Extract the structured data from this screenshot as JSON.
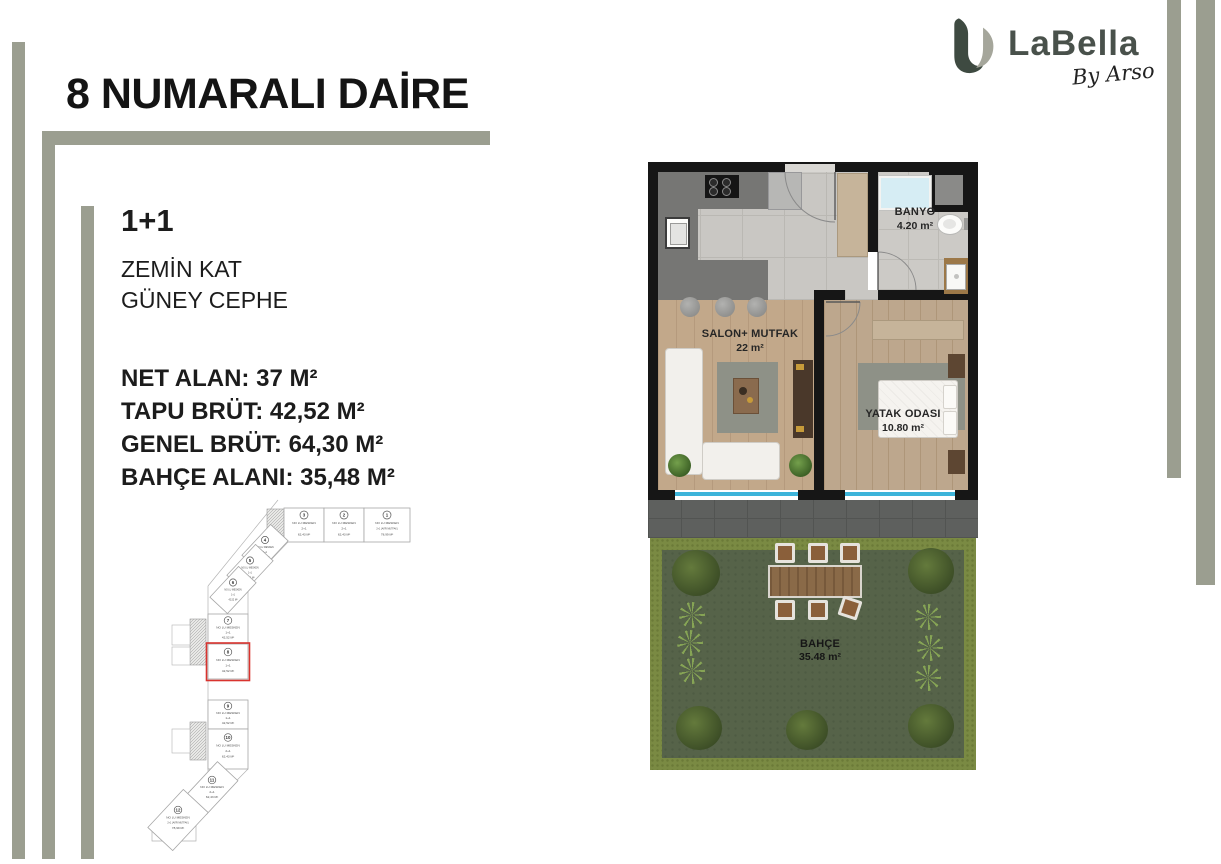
{
  "page": {
    "title": "8 NUMARALI DAİRE"
  },
  "brand": {
    "name": "LaBella",
    "byline": "By Arso",
    "logo_dark_color": "#3e4a41",
    "logo_gray_color": "#a5a69b"
  },
  "apartment": {
    "type": "1+1",
    "floor": "ZEMİN KAT",
    "facade": "GÜNEY CEPHE",
    "stats": [
      "NET ALAN: 37 M²",
      "TAPU BRÜT: 42,52 M²",
      "GENEL BRÜT: 64,30 M²",
      "BAHÇE ALANI: 35,48 M²"
    ]
  },
  "keyplan": {
    "highlight_color": "#d9332e",
    "highlighted_unit": "8",
    "units": [
      {
        "no": "1",
        "name": "NO LU MESKEN",
        "type": "2+1 (AYRI MUTFAK)",
        "area": "78,99 M²"
      },
      {
        "no": "2",
        "name": "NO LU MESKEN",
        "type": "2+1",
        "area": "62,43 M²"
      },
      {
        "no": "3",
        "name": "NO LU MESKEN",
        "type": "2+1",
        "area": "62,43 M²"
      },
      {
        "no": "4",
        "name": "NO LU MESKEN",
        "type": "1+1",
        "area": "42,52 M²"
      },
      {
        "no": "5",
        "name": "NO LU MESKEN",
        "type": "1+1",
        "area": "42,52 M²"
      },
      {
        "no": "6",
        "name": "NO LU MESKEN",
        "type": "1+1",
        "area": "42,52 M²"
      },
      {
        "no": "7",
        "name": "NO LU MESKEN",
        "type": "1+1",
        "area": "42,52 M²"
      },
      {
        "no": "8",
        "name": "NO LU MESKEN",
        "type": "1+1",
        "area": "42,52 M²"
      },
      {
        "no": "9",
        "name": "NO LU MESKEN",
        "type": "1+1",
        "area": "42,52 M²"
      },
      {
        "no": "10",
        "name": "NO LU MESKEN",
        "type": "2+1",
        "area": "62,43 M²"
      },
      {
        "no": "11",
        "name": "NO LU MESKEN",
        "type": "2+1",
        "area": "62,43 M²"
      },
      {
        "no": "12",
        "name": "NO LU MESKEN",
        "type": "2+1 (AYRI MUTFAK)",
        "area": "78,99 M²"
      }
    ]
  },
  "floorplan": {
    "rooms": [
      {
        "name": "SALON+ MUTFAK",
        "area": "22 m²"
      },
      {
        "name": "BANYO",
        "area": "4.20 m²"
      },
      {
        "name": "YATAK ODASI",
        "area": "10.80 m²"
      },
      {
        "name": "BAHÇE",
        "area": "35.48 m²"
      }
    ],
    "colors": {
      "wall": "#161616",
      "window": "#3db4da",
      "grass": "#566349",
      "hedge": "#7a8a43",
      "frame": "#9b9e90"
    }
  }
}
